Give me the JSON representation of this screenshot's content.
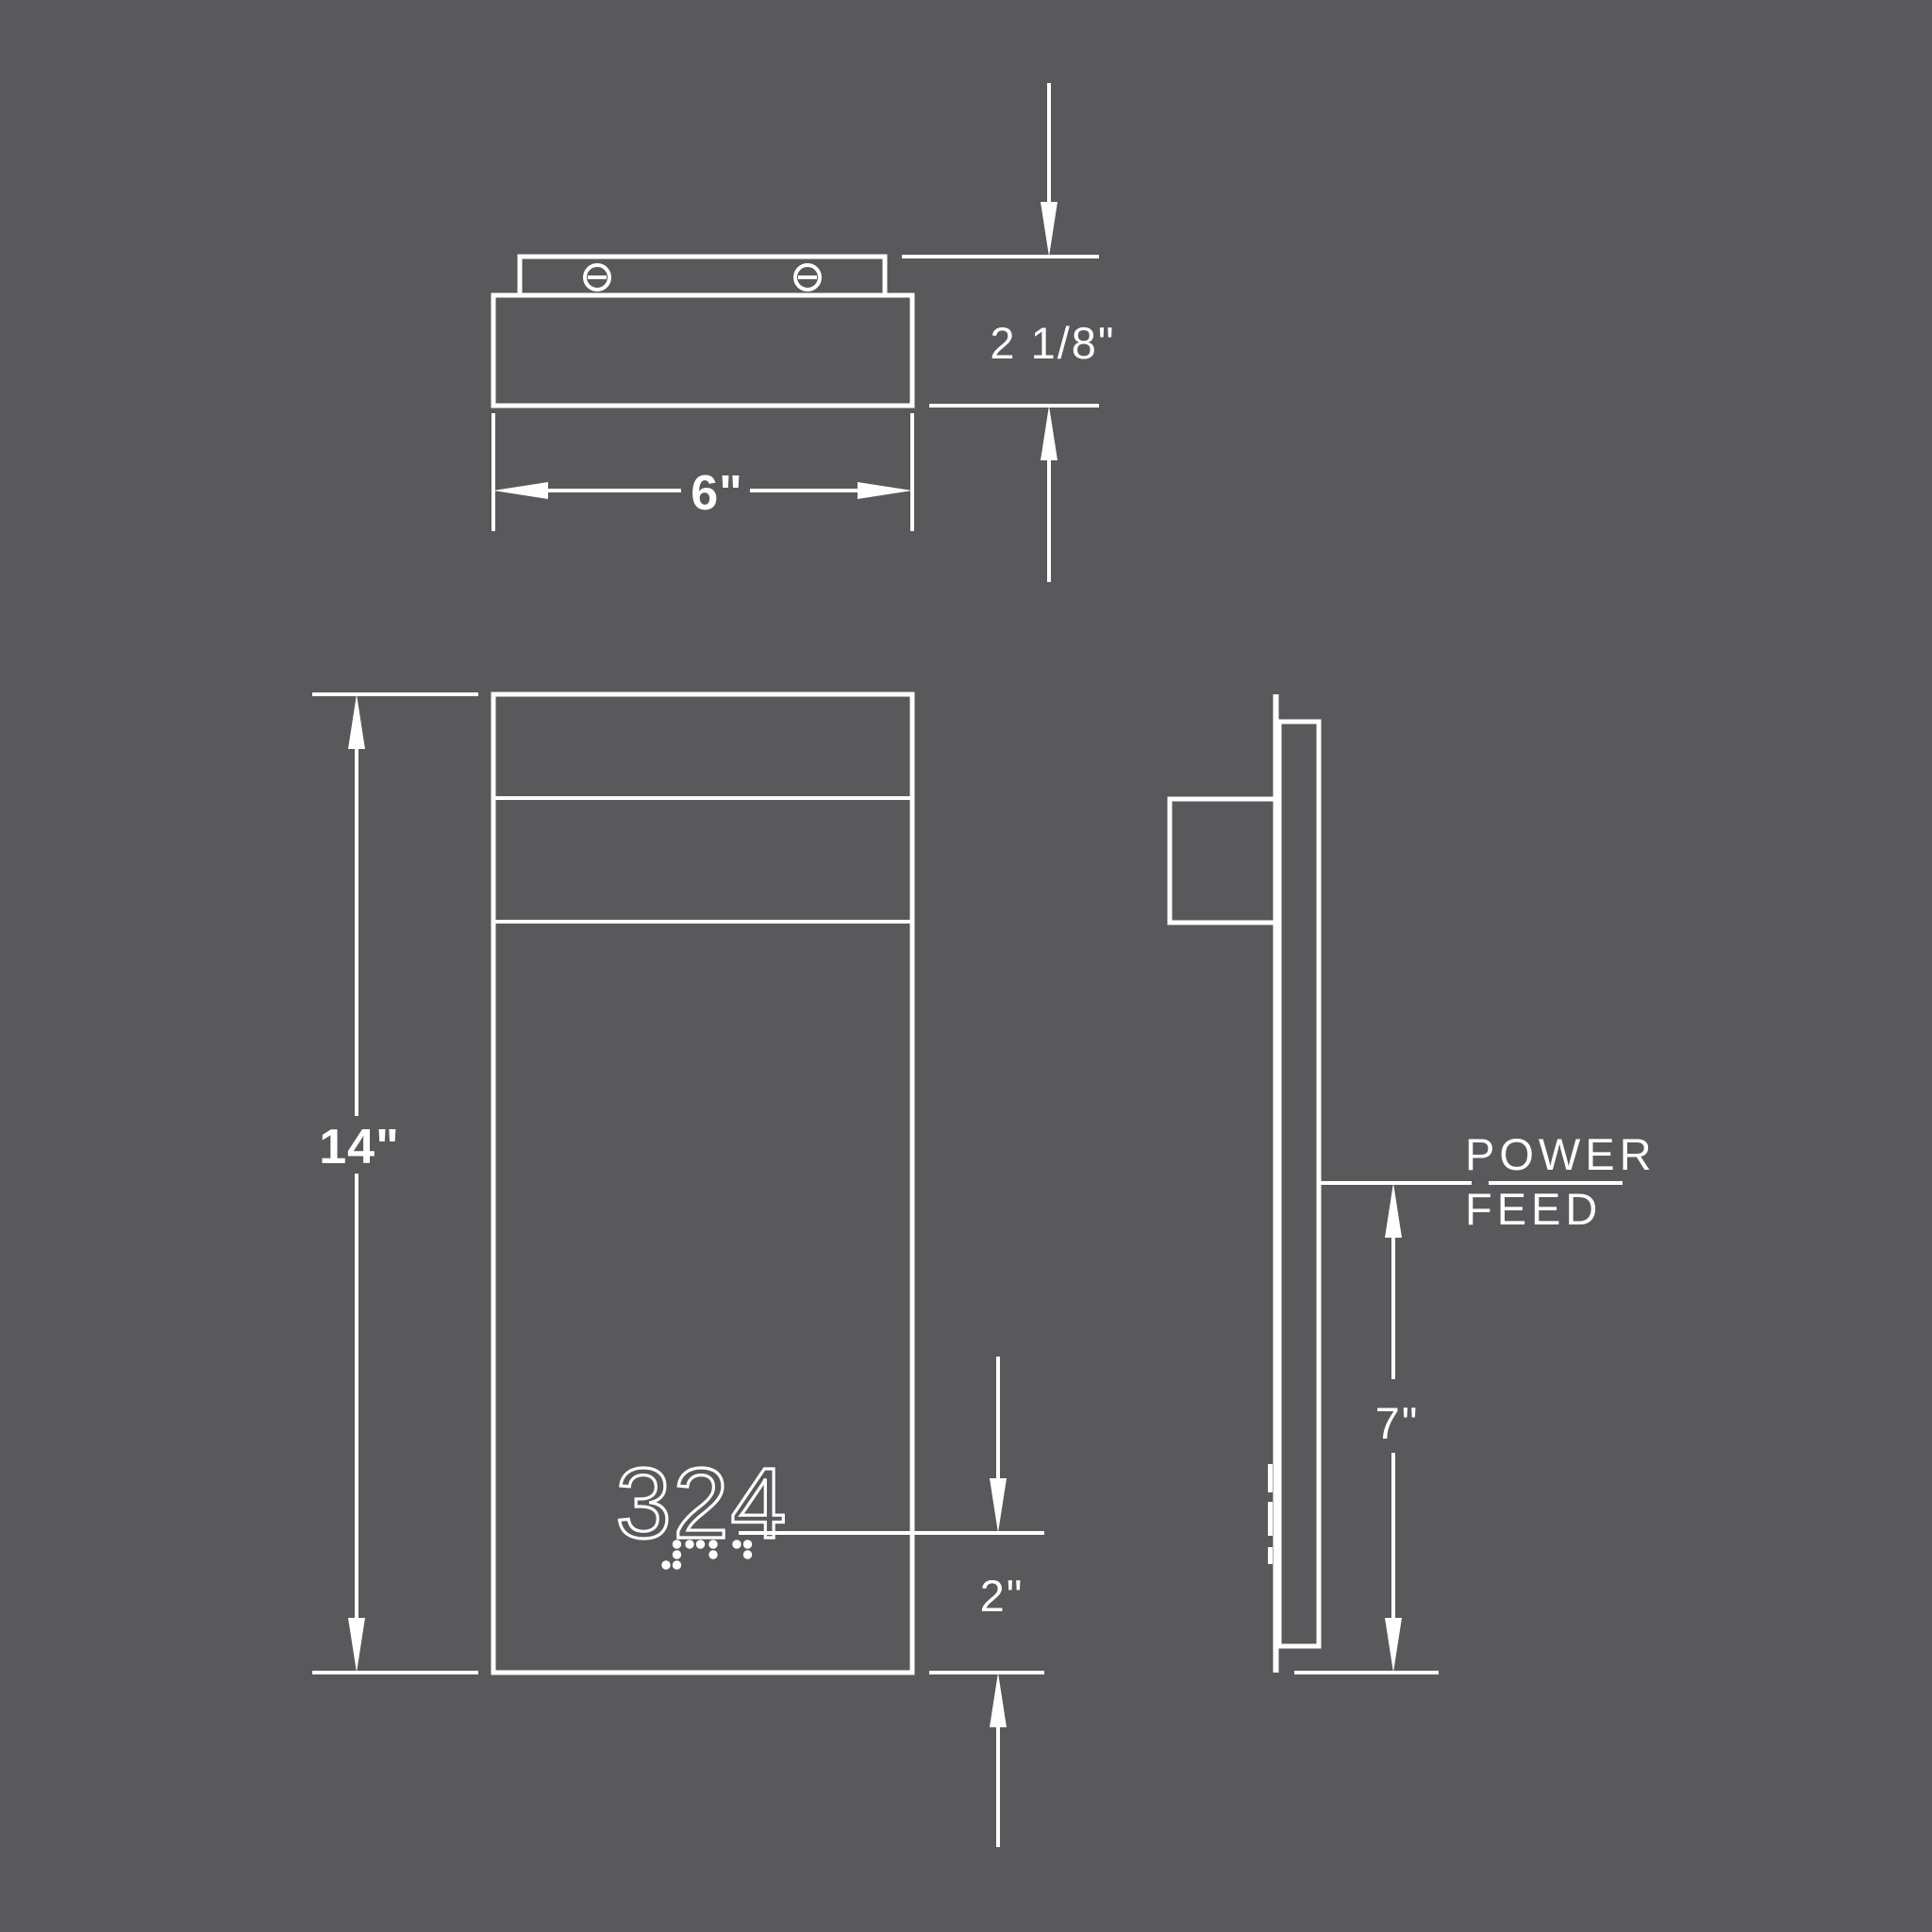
{
  "canvas": {
    "background_color": "#59595b",
    "line_color": "#ffffff"
  },
  "top_view": {
    "depth_label": "2 1/8\"",
    "width_label": "6\"",
    "screws": [
      "screw-icon-left",
      "screw-icon-right"
    ]
  },
  "front_view": {
    "height_label": "14\"",
    "room_number": "324",
    "number_offset_label": "2\"",
    "braille": {
      "text": "324",
      "cells": [
        [
          [
            0,
            2
          ],
          [
            1,
            0
          ],
          [
            1,
            1
          ],
          [
            1,
            2
          ]
        ],
        [
          [
            0,
            0
          ],
          [
            1,
            0
          ]
        ],
        [
          [
            0,
            0
          ],
          [
            0,
            1
          ]
        ],
        [
          [
            0,
            0
          ],
          [
            1,
            0
          ],
          [
            1,
            1
          ]
        ]
      ]
    }
  },
  "side_view": {
    "power_label_line1": "POWER",
    "power_label_line2": "FEED",
    "feed_height_label": "7\""
  }
}
